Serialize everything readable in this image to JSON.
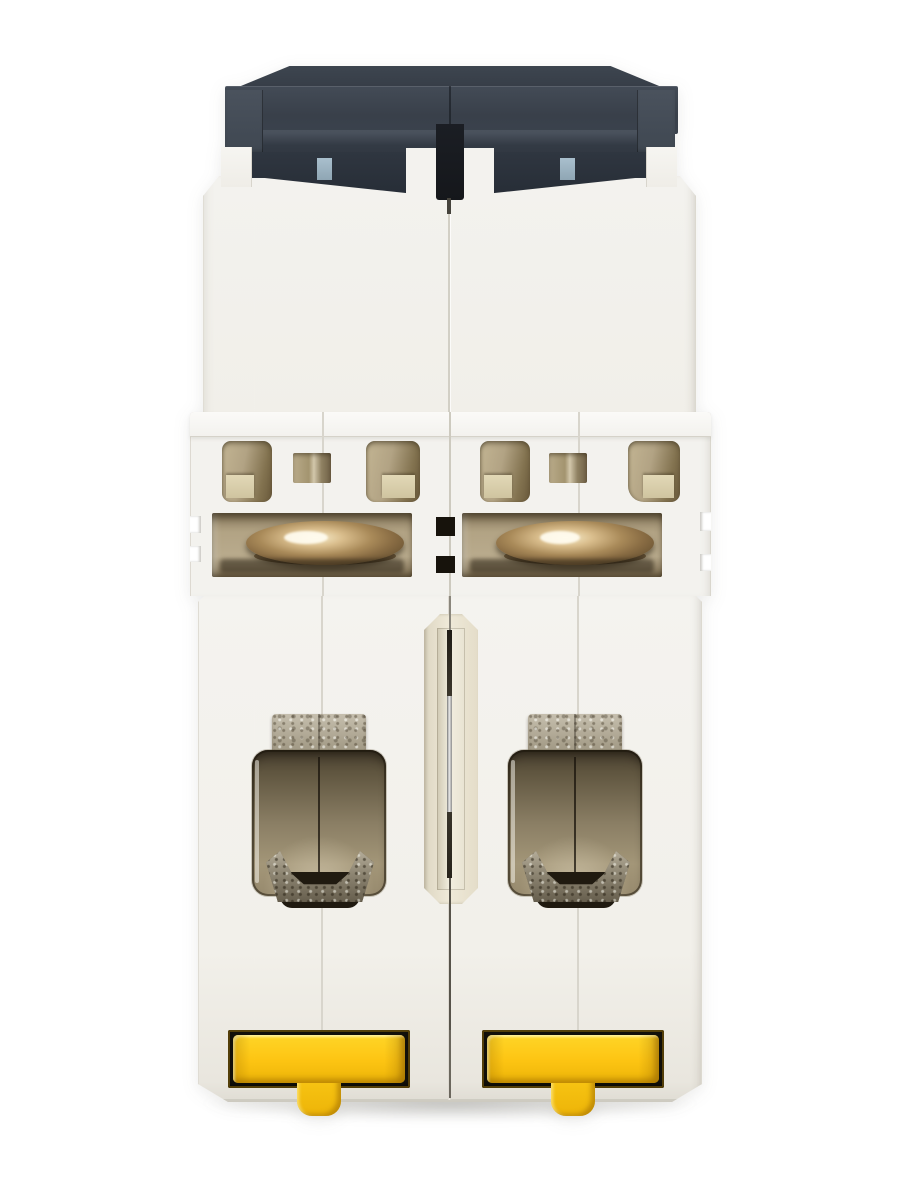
{
  "scene": {
    "type": "product-photo",
    "subject": "Two-pole DIN-rail miniature circuit breaker, rear (rail-side) view",
    "pole_count": 2,
    "visible_text": "",
    "canvas": {
      "width": 900,
      "height": 1200
    }
  },
  "parts": [
    "dark housing cap",
    "cap latch tabs (blue-grey)",
    "white molded housing, left pole",
    "white molded housing, right pole",
    "arc-vent openings",
    "solenoid coil (brass), left pole",
    "solenoid coil (brass), right pole",
    "pole-link slot with metal rod",
    "screw terminal cavity, left pole",
    "screw terminal cavity, right pole",
    "terminal clamp, left pole",
    "terminal clamp, right pole",
    "DIN-rail clip (yellow), left pole",
    "DIN-rail clip (yellow), right pole"
  ],
  "colors": {
    "background": "#ffffff",
    "body": "#f3f2ee",
    "bodyShade": "#e9e7e0",
    "bodyEdge": "#d8d5cc",
    "capTop": "#39404a",
    "capBand": "#3e4650",
    "capDark": "#2c333d",
    "capBlack": "#15171b",
    "blueTab": "#a9bfcd",
    "ventTan": "#b2a384",
    "ventTanDark": "#7c6d50",
    "ventTanLight": "#d6cba9",
    "brass": "#8a6d44",
    "brassLight": "#f7ecca",
    "brassDark": "#4e3d26",
    "terminalDark": "#3f372a",
    "terminalMid": "#80745d",
    "terminalLight": "#9c9077",
    "metal": "#b3ac9b",
    "metalDark": "#6b6354",
    "slotCream": "#f2eedf",
    "slotEdge": "#d9d2bd",
    "rodSilver": "#e8e8e8",
    "rodDark": "#2f2b23",
    "yellow": "#fdc513",
    "yellowLight": "#ffd527",
    "yellowDeep": "#edb408",
    "amberDark": "#6e4f03",
    "slotBlack": "#12100a",
    "groundShadow": "rgba(110,108,100,0.35)"
  }
}
